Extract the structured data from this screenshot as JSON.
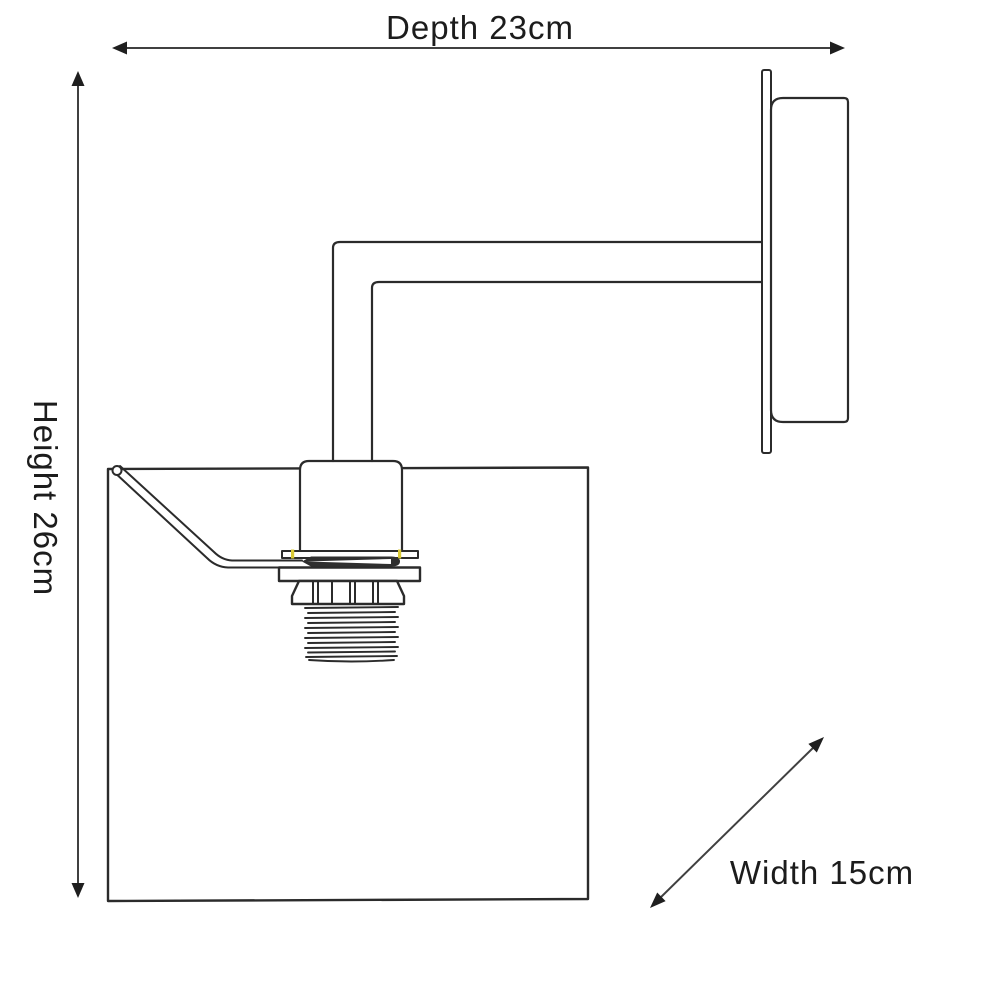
{
  "dimensions": {
    "depth": {
      "label": "Depth 23cm",
      "value": 23,
      "unit": "cm"
    },
    "height": {
      "label": "Height 26cm",
      "value": 26,
      "unit": "cm"
    },
    "width": {
      "label": "Width 15cm",
      "value": 15,
      "unit": "cm"
    }
  },
  "colors": {
    "background": "#ffffff",
    "drawing_line": "#2b2b2b",
    "dimension_line": "#404040",
    "text": "#1c1c1c",
    "highlight_tick": "#d9c934"
  }
}
